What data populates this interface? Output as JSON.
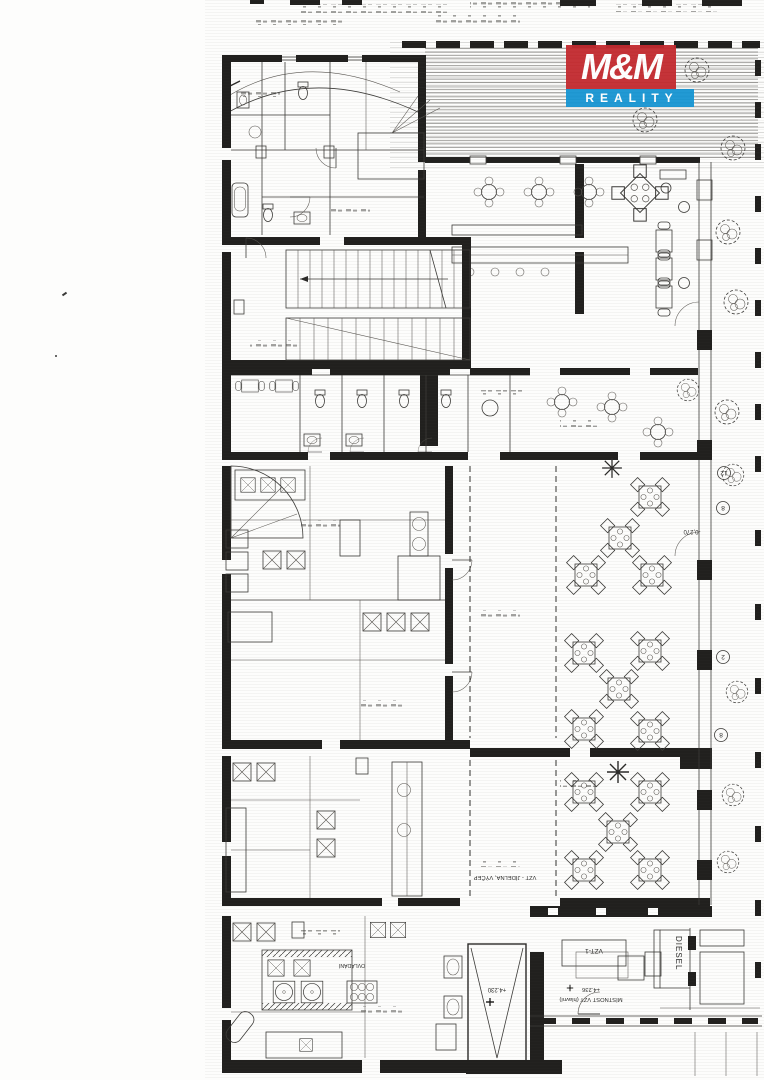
{
  "logo": {
    "line1": "M&M",
    "line2": "REALITY",
    "red": "#c32a2f",
    "blue": "#1795d2"
  },
  "labels": {
    "diesel": "DIESEL",
    "vzt_unit": "VZT-1",
    "vzt_room": "MÍSTNOST VZT (hlavní)",
    "vzt_room_elev": "+4.236",
    "shaft_elev": "+4.230",
    "duct_note": "VZT - JÍDELNA, VÝČEP",
    "control_note": "OVLÁDÁNÍ",
    "terrace_elev": "-0,270"
  },
  "axis_markers": [
    "12",
    "8",
    "2",
    "8"
  ]
}
